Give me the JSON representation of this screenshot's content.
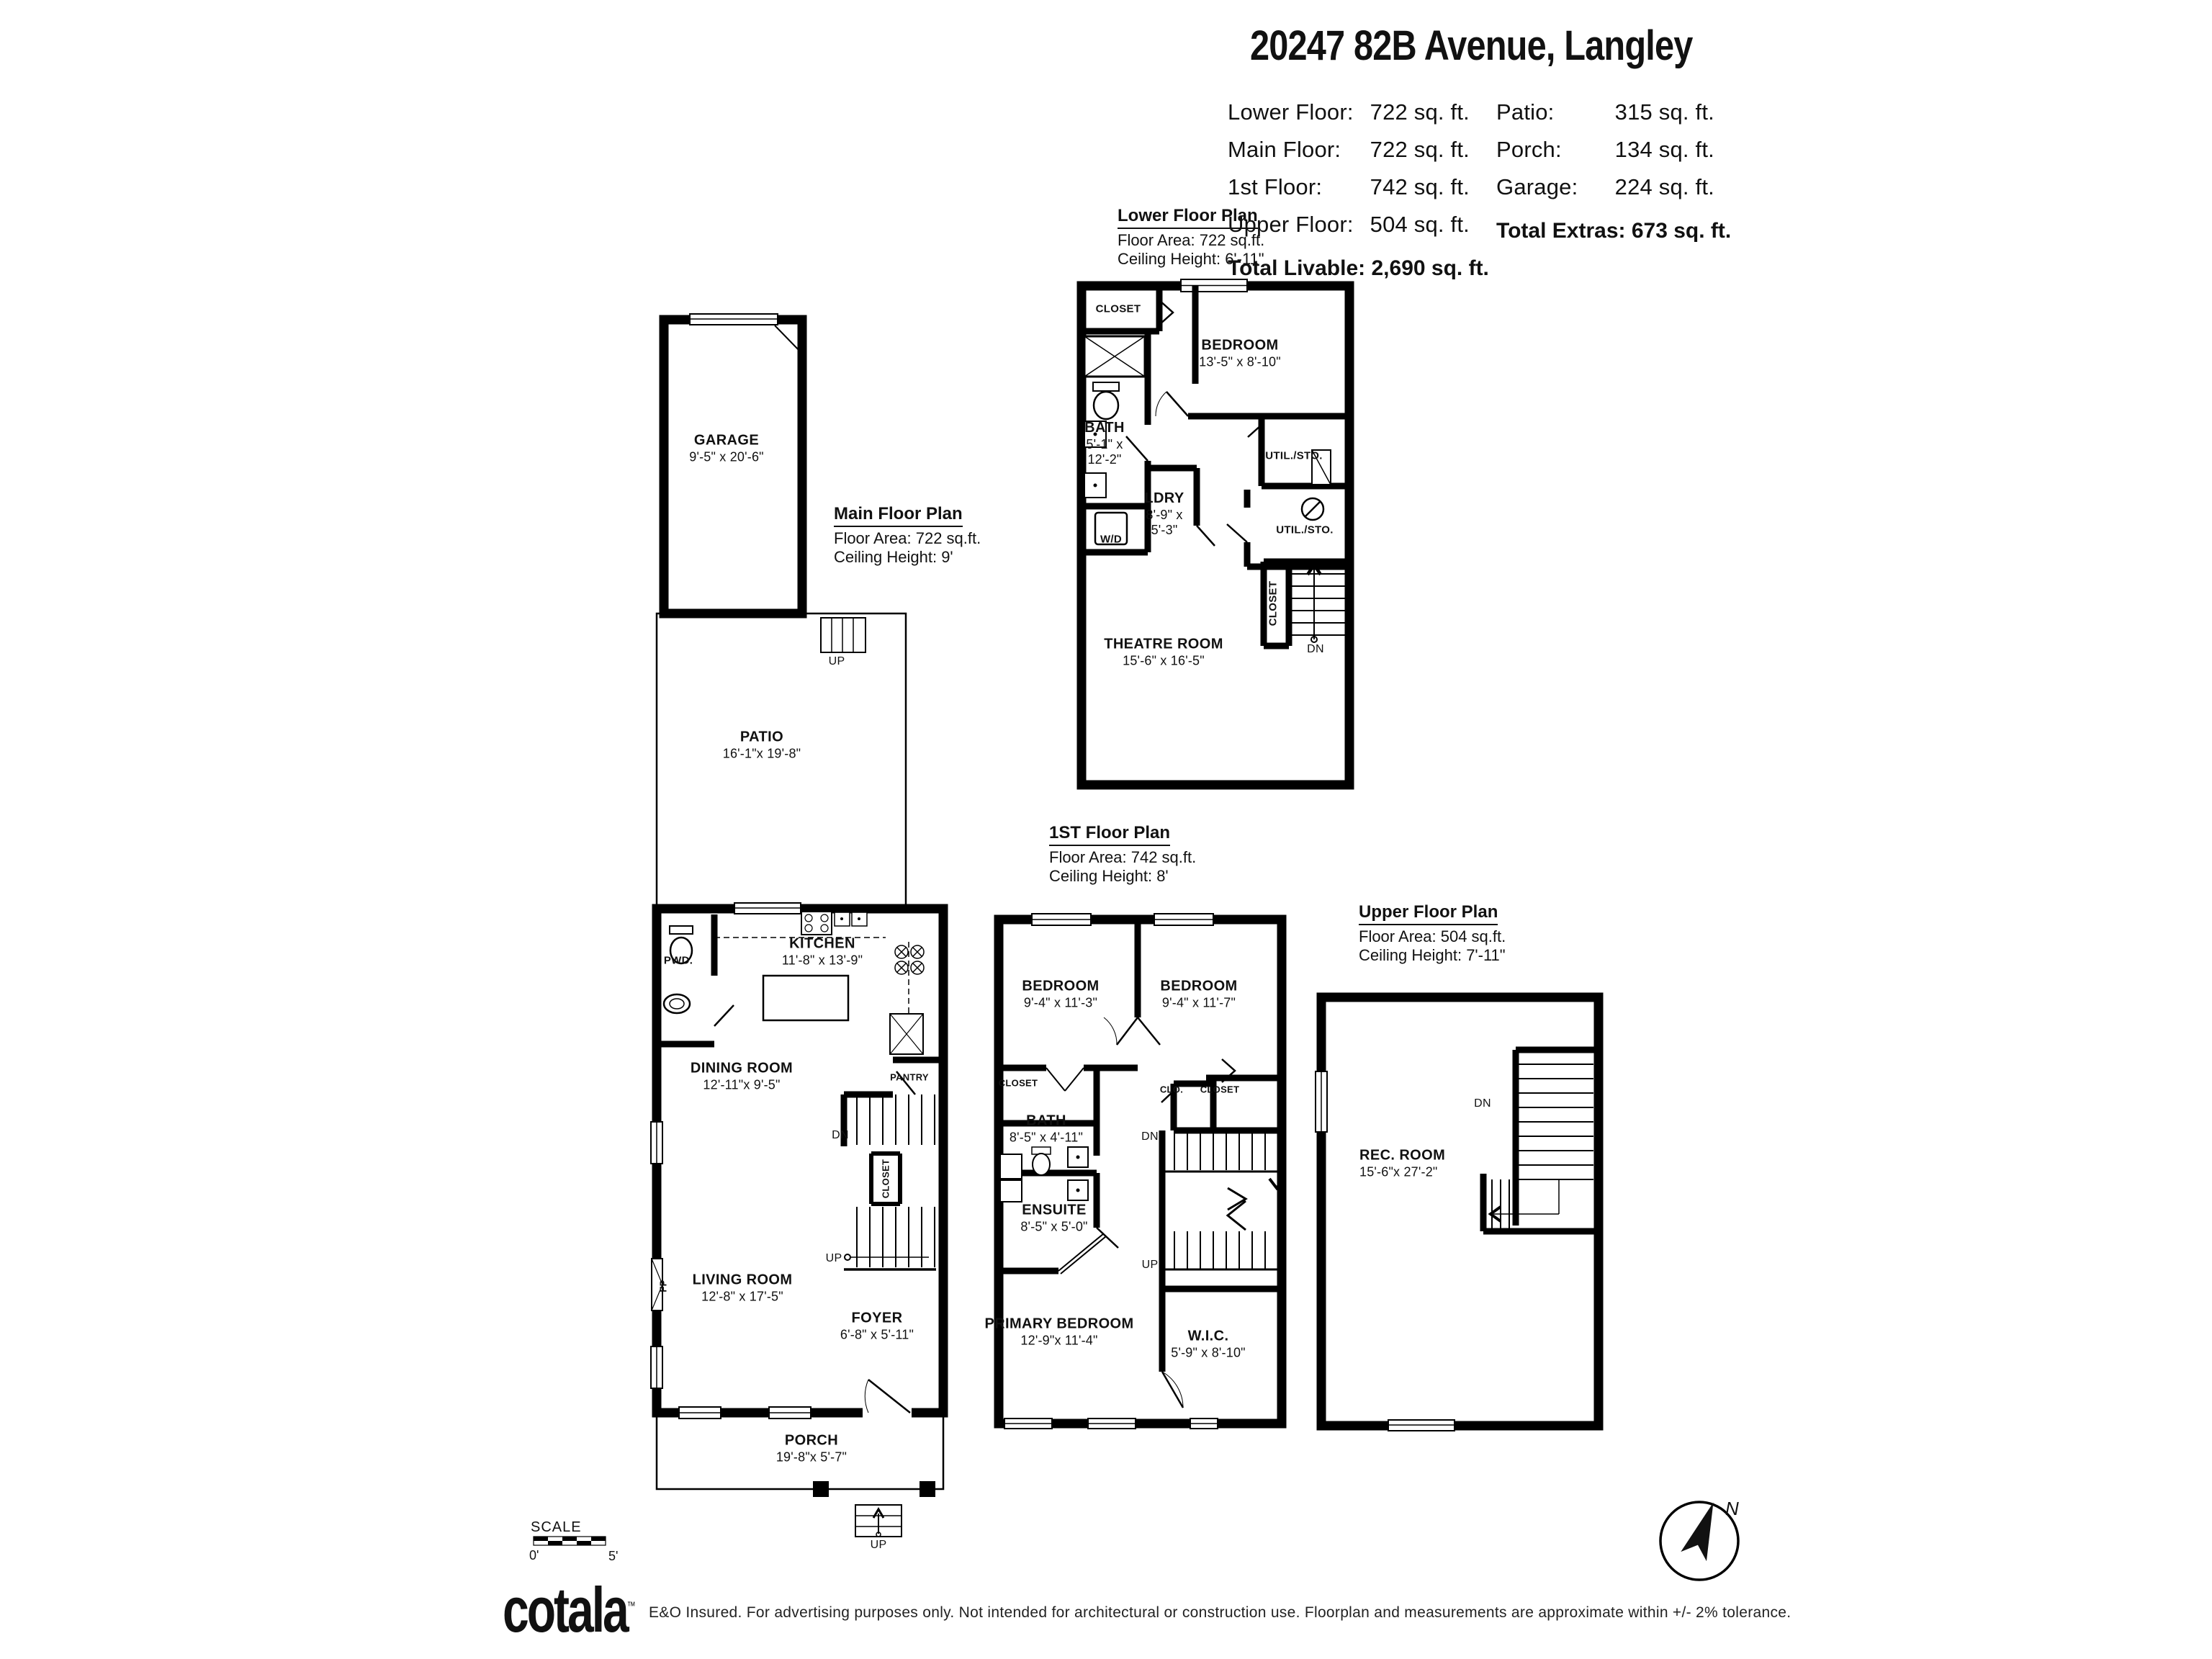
{
  "header": {
    "title": "20247 82B Avenue, Langley",
    "stats_left": [
      {
        "label": "Lower Floor:",
        "value": "722 sq. ft."
      },
      {
        "label": "Main Floor:",
        "value": "722 sq. ft."
      },
      {
        "label": "1st Floor:",
        "value": "742 sq. ft."
      },
      {
        "label": "Upper Floor:",
        "value": "504 sq. ft."
      }
    ],
    "stats_right": [
      {
        "label": "Patio:",
        "value": "315 sq. ft."
      },
      {
        "label": "Porch:",
        "value": "134 sq. ft."
      },
      {
        "label": "Garage:",
        "value": "224 sq. ft."
      }
    ],
    "total_extras": {
      "label": "Total Extras:",
      "value": "673 sq. ft."
    },
    "total_livable": {
      "label": "Total Livable:",
      "value": "2,690 sq. ft."
    }
  },
  "plans": {
    "lower": {
      "title": "Lower Floor Plan",
      "area": "Floor Area: 722 sq.ft.",
      "ceiling": "Ceiling Height: 6'-11\""
    },
    "main": {
      "title": "Main Floor Plan",
      "area": "Floor Area: 722 sq.ft.",
      "ceiling": "Ceiling Height: 9'"
    },
    "first": {
      "title": "1ST Floor Plan",
      "area": "Floor Area: 742 sq.ft.",
      "ceiling": "Ceiling Height: 8'"
    },
    "upper": {
      "title": "Upper Floor Plan",
      "area": "Floor Area: 504 sq.ft.",
      "ceiling": "Ceiling Height: 7'-11\""
    }
  },
  "rooms": {
    "garage": {
      "name": "GARAGE",
      "dims": "9'-5\" x 20'-6\""
    },
    "patio": {
      "name": "PATIO",
      "dims": "16'-1\"x 19'-8\""
    },
    "kitchen": {
      "name": "KITCHEN",
      "dims": "11'-8\" x 13'-9\""
    },
    "dining": {
      "name": "DINING ROOM",
      "dims": "12'-11\"x  9'-5\""
    },
    "living": {
      "name": "LIVING ROOM",
      "dims": "12'-8\" x 17'-5\""
    },
    "foyer": {
      "name": "FOYER",
      "dims": "6'-8\" x 5'-11\""
    },
    "porch": {
      "name": "PORCH",
      "dims": "19'-8\"x  5'-7\""
    },
    "lower_bedroom": {
      "name": "BEDROOM",
      "dims": "13'-5\" x 8'-10\""
    },
    "lower_bath": {
      "name": "BATH",
      "dims": "5'-1\" x 12'-2\""
    },
    "ldry": {
      "name": "LDRY",
      "dims": "8'-9\" x 5'-3\""
    },
    "theatre": {
      "name": "THEATRE ROOM",
      "dims": "15'-6\" x 16'-5\""
    },
    "bedroom1": {
      "name": "BEDROOM",
      "dims": "9'-4\" x 11'-3\""
    },
    "bedroom2": {
      "name": "BEDROOM",
      "dims": "9'-4\" x 11'-7\""
    },
    "bath1": {
      "name": "BATH",
      "dims": "8'-5\" x 4'-11\""
    },
    "ensuite": {
      "name": "ENSUITE",
      "dims": "8'-5\" x 5'-0\""
    },
    "primary": {
      "name": "PRIMARY BEDROOM",
      "dims": "12'-9\"x 11'-4\""
    },
    "wic": {
      "name": "W.I.C.",
      "dims": "5'-9\" x 8'-10\""
    },
    "rec": {
      "name": "REC. ROOM",
      "dims": "15'-6\"x 27'-2\""
    }
  },
  "labels": {
    "closet": "CLOSET",
    "clo": "CLO.",
    "pwd": "PWD.",
    "pantry": "PANTRY",
    "wd": "W/D",
    "util_sto": "UTIL./STO.",
    "up": "UP",
    "dn": "DN",
    "fp": "FP"
  },
  "scale": {
    "label": "SCALE",
    "start": "0'",
    "end": "5'"
  },
  "compass": {
    "north": "N"
  },
  "footer": {
    "logo": "cotala",
    "tm": "™",
    "disclaimer": "E&O Insured. For advertising purposes only. Not intended for architectural or construction use. Floorplan and measurements are approximate within +/- 2% tolerance."
  }
}
